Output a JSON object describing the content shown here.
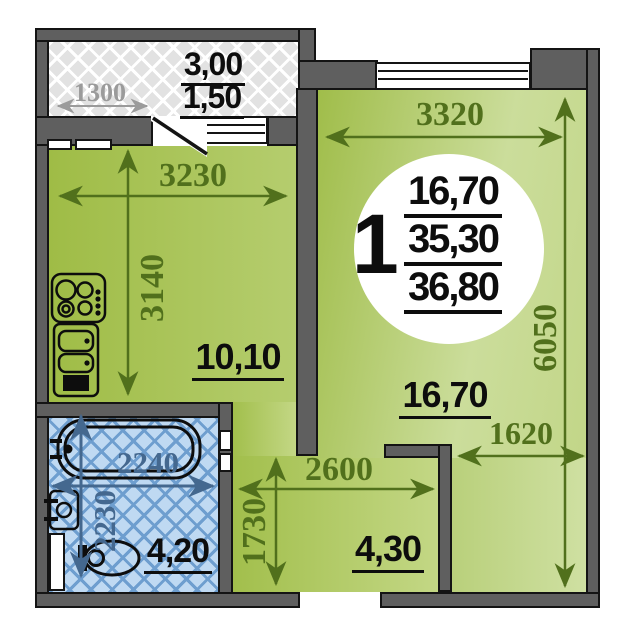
{
  "unit_badge": {
    "rooms": "1",
    "living_area": "16,70",
    "total_area": "35,30",
    "overall_area": "36,80"
  },
  "kitchen": {
    "area": "10,10",
    "width": "3230",
    "depth": "3140"
  },
  "living_room": {
    "area": "16,70",
    "width": "3320",
    "depth": "6050",
    "alcove_width": "1620"
  },
  "hallway": {
    "area": "4,30",
    "width": "2600",
    "depth": "1730"
  },
  "bathroom": {
    "area": "4,20",
    "width": "2240",
    "depth": "2230"
  },
  "balcony": {
    "area_full": "3,00",
    "area_counted": "1,50",
    "width": "1300"
  },
  "fixtures": {
    "kitchen": [
      "stove",
      "sink"
    ],
    "bathroom": [
      "bathtub",
      "washbasin",
      "toilet"
    ]
  },
  "colors": {
    "wall": "#5f5f5f",
    "wall_outline": "#141414",
    "kitchen_green": "#a6c153",
    "living_green": "#c6da92",
    "bathroom_blue": "#bfd9f2",
    "bathroom_hatch": "#6e9ecf",
    "balcony_gray": "#e2e2e2",
    "dim_olive": "#51701c",
    "dim_slate": "#44688f",
    "dim_gray": "#9b9b9b",
    "label_black": "#0d0d0d"
  }
}
